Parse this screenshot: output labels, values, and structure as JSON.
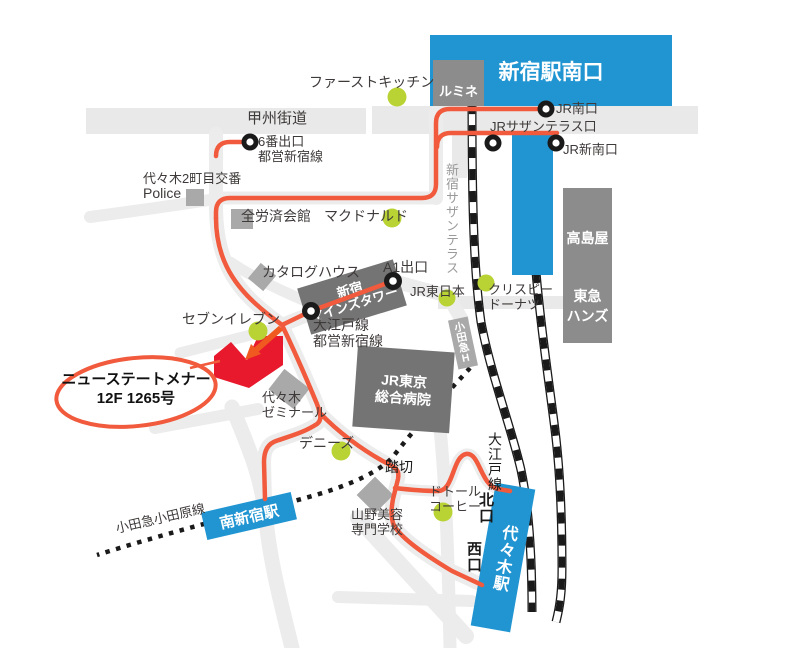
{
  "colors": {
    "blue": "#2095d2",
    "route": "#f15a3c",
    "red": "#e8192d",
    "arrow": "#f0591f",
    "green": "#b9d335",
    "road": "#ececec",
    "band": "#e9e9e9",
    "box-dark": "#747474",
    "box-mid": "#8c8c8c",
    "box-light": "#a9a9a9",
    "ink": "#3e3a39",
    "black": "#1a1a1a"
  },
  "stations": {
    "shinjuku_south": "新宿駅南口",
    "lumine": "ルミネ",
    "minami_shinjuku": "南新宿駅",
    "yoyogi": "代々木駅"
  },
  "exits": {
    "jr_minami": "JR南口",
    "southern_terrace_exit": "JRサザンテラス口",
    "jr_shin_minami": "JR新南口",
    "exit6_l1": "6番出口",
    "exit6_l2": "都営新宿線",
    "a1": "A1出口",
    "kita": "北口",
    "nishi": "西口"
  },
  "roads": {
    "koshu": "甲州街道",
    "southern_terrace_walk": "新宿サザンテラス",
    "fumikiri": "踏切"
  },
  "rail_lines": {
    "oedo_toei_l1": "大江戸線",
    "oedo_toei_l2": "都営新宿線",
    "oedo": "大江戸線",
    "odakyu_odawara": "小田急小田原線"
  },
  "landmarks": {
    "first_kitchen": "ファーストキッチン",
    "koban_l1": "代々木2町目交番",
    "koban_l2": "Police",
    "zenrosai": "全労済会館",
    "mcdonalds": "マクドナルド",
    "takashimaya": "高島屋",
    "tokyu_hands_l1": "東急",
    "tokyu_hands_l2": "ハンズ",
    "catalog_house": "カタログハウス",
    "minds_l1": "新宿",
    "minds_l2": "マインズタワー",
    "jr_east": "JR東日本",
    "krispy_l1": "クリスピー",
    "krispy_l2": "ドーナツ",
    "seven_eleven": "セブンイレブン",
    "odakyu_h": "小田急H",
    "zemi_l1": "代々木",
    "zemi_l2": "ゼミナール",
    "hospital_l1": "JR東京",
    "hospital_l2": "総合病院",
    "dennys": "デニーズ",
    "dotour_l1": "ドトール",
    "dotour_l2": "コーヒー",
    "yamano_l1": "山野美容",
    "yamano_l2": "専門学校"
  },
  "destination": {
    "line1": "ニューステートメナー",
    "line2": "12F 1265号"
  }
}
